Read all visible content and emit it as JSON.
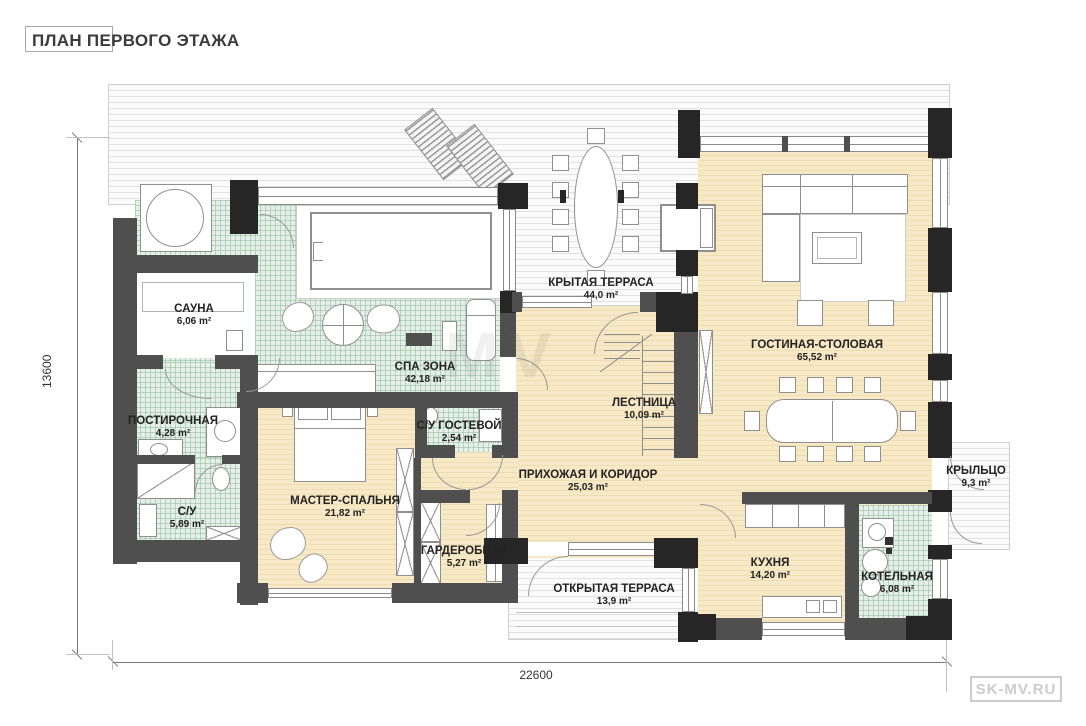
{
  "title": "ПЛАН ПЕРВОГО ЭТАЖА",
  "watermark_bottom_right": "SK-MV.RU",
  "watermark_center": "MV",
  "dimensions": {
    "bottom": "22600",
    "left": "13600"
  },
  "colors": {
    "floor_beige": "#f5e4c0",
    "floor_tile_green": "#e4efe8",
    "wall_dark": "#4f4f4f",
    "pier_black": "#262626",
    "deck_stripe": "#e1e1e1"
  },
  "rooms": [
    {
      "name": "САУНА",
      "area": "6,06 m²"
    },
    {
      "name": "СПА ЗОНА",
      "area": "42,18 m²"
    },
    {
      "name": "КРЫТАЯ ТЕРРАСА",
      "area": "44,0 m²"
    },
    {
      "name": "ГОСТИНАЯ-СТОЛОВАЯ",
      "area": "65,52 m²"
    },
    {
      "name": "ЛЕСТНИЦА",
      "area": "10,09 m²"
    },
    {
      "name": "ПОСТИРОЧНАЯ",
      "area": "4,28 m²"
    },
    {
      "name": "С/У ГОСТЕВОЙ",
      "area": "2,54 m²"
    },
    {
      "name": "ПРИХОЖАЯ И КОРИДОР",
      "area": "25,03 m²"
    },
    {
      "name": "МАСТЕР-СПАЛЬНЯ",
      "area": "21,82 m²"
    },
    {
      "name": "С/У",
      "area": "5,89 m²"
    },
    {
      "name": "ГАРДЕРОБНАЯ",
      "area": "5,27 m²"
    },
    {
      "name": "ОТКРЫТАЯ ТЕРРАСА",
      "area": "13,9 m²"
    },
    {
      "name": "КУХНЯ",
      "area": "14,20 m²"
    },
    {
      "name": "КОТЕЛЬНАЯ",
      "area": "6,08 m²"
    },
    {
      "name": "КРЫЛЬЦО",
      "area": "9,3 m²"
    }
  ]
}
